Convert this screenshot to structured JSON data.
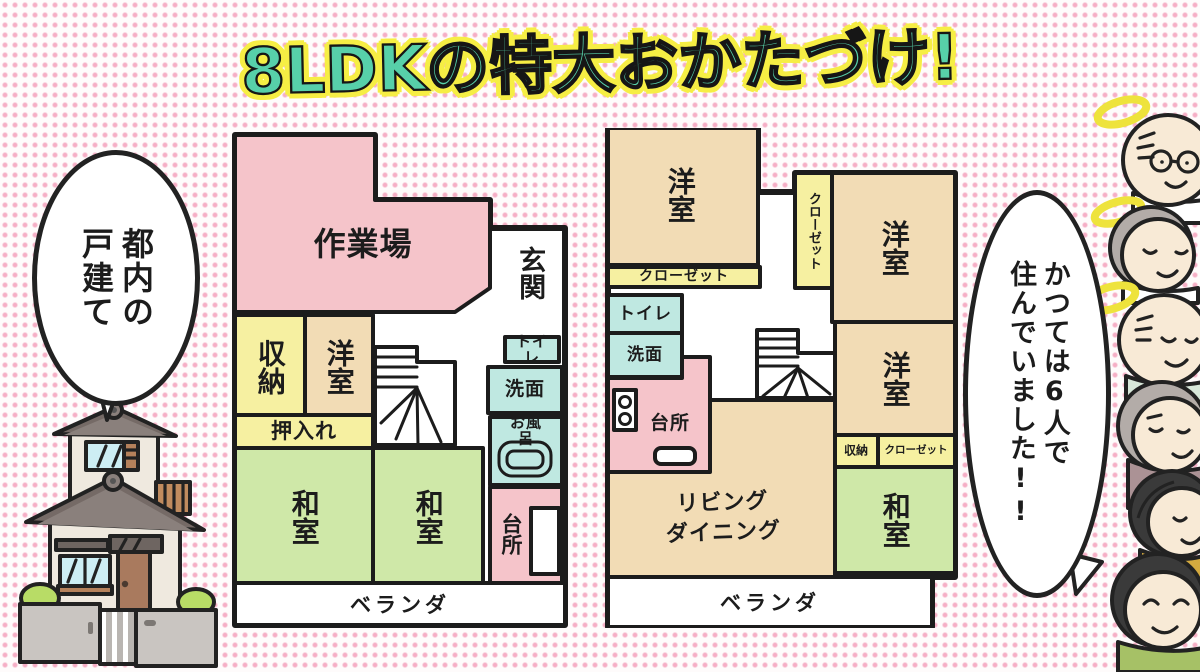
{
  "palette": {
    "c-pink": "#f5c4ca",
    "c-yellow": "#f6f0a1",
    "c-tan": "#f2dcb5",
    "c-green": "#cfe8a8",
    "c-cyan": "#bfe8e1",
    "c-wall": "#1c1c1c",
    "c-title": "#57d0a9",
    "c-outline": "#f6ee44",
    "c-halo": "#eee33c",
    "c-dot": "#f5aec5",
    "c-skin": "#f8ead6",
    "c-gray-hair": "#b3aca8",
    "c-black-hair": "#3a3a3a",
    "c-clothes-mauve": "#ab9295",
    "c-clothes-mustard": "#d4aa3f",
    "c-clothes-green": "#a6c166"
  },
  "title": "8LDKの特大おかたづけ!",
  "bubbles": {
    "left": "都内の\n戸建て",
    "right": "かつては6人で\n住んでいました!!"
  },
  "plans": [
    {
      "name": "1F",
      "rooms": {
        "workshop": "作業場",
        "entrance": "玄関",
        "storage": "収納",
        "western_room": "洋室",
        "oshiire": "押入れ",
        "toilet": "トイレ",
        "washroom": "洗面",
        "bath": "お風呂",
        "kitchen": "台所",
        "japanese_room_a": "和室",
        "japanese_room_b": "和室",
        "veranda": "ベランダ"
      }
    },
    {
      "name": "2F",
      "rooms": {
        "western_room_a": "洋室",
        "closet_tall": "クローゼット",
        "western_room_b": "洋室",
        "closet_wide": "クローゼット",
        "toilet": "トイレ",
        "washroom": "洗面",
        "kitchen": "台所",
        "western_room_c": "洋室",
        "storage": "収納",
        "closet_small": "クローゼット",
        "japanese_room": "和室",
        "living_dining": "リビング\nダイニング",
        "veranda": "ベランダ"
      }
    }
  ]
}
